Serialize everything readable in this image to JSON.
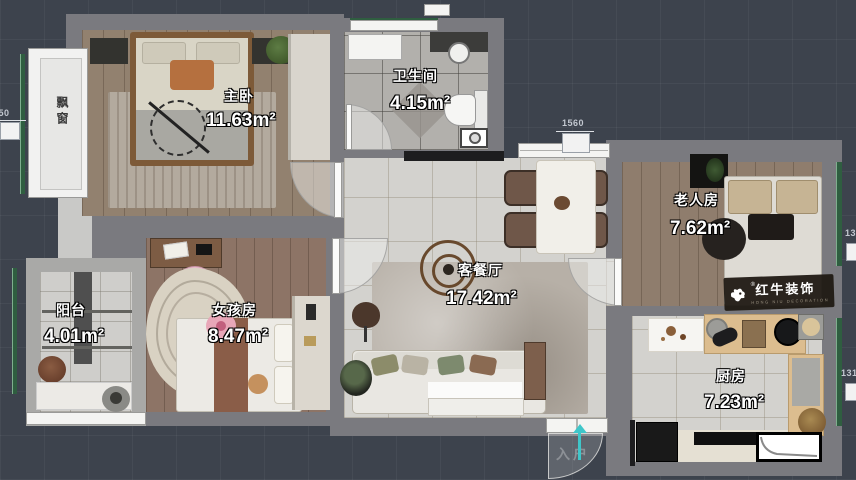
{
  "colors": {
    "background": "#3d434d",
    "wall": "#7a7a7f",
    "window_green": "#2f5e40",
    "arrow_teal": "#3fc6c9",
    "label_text": "#ffffff"
  },
  "rooms": [
    {
      "id": "master-bedroom",
      "name": "主卧",
      "area": "11.63m²"
    },
    {
      "id": "bathroom",
      "name": "卫生间",
      "area": "4.15m²"
    },
    {
      "id": "living-dining",
      "name": "客餐厅",
      "area": "17.42m²"
    },
    {
      "id": "elder-room",
      "name": "老人房",
      "area": "7.62m²"
    },
    {
      "id": "girl-room",
      "name": "女孩房",
      "area": "8.47m²"
    },
    {
      "id": "balcony",
      "name": "阳台",
      "area": "4.01m²"
    },
    {
      "id": "kitchen",
      "name": "厨房",
      "area": "7.23m²"
    }
  ],
  "annotations": {
    "bay_window": "飘窗",
    "entry": "入户"
  },
  "dimensions": {
    "top": "1560",
    "left": "350",
    "right_upper": "13",
    "right_lower": "131"
  },
  "logo": {
    "brand": "红牛装饰",
    "subtitle": "HONG NIU DECORATION",
    "registered": "®"
  }
}
